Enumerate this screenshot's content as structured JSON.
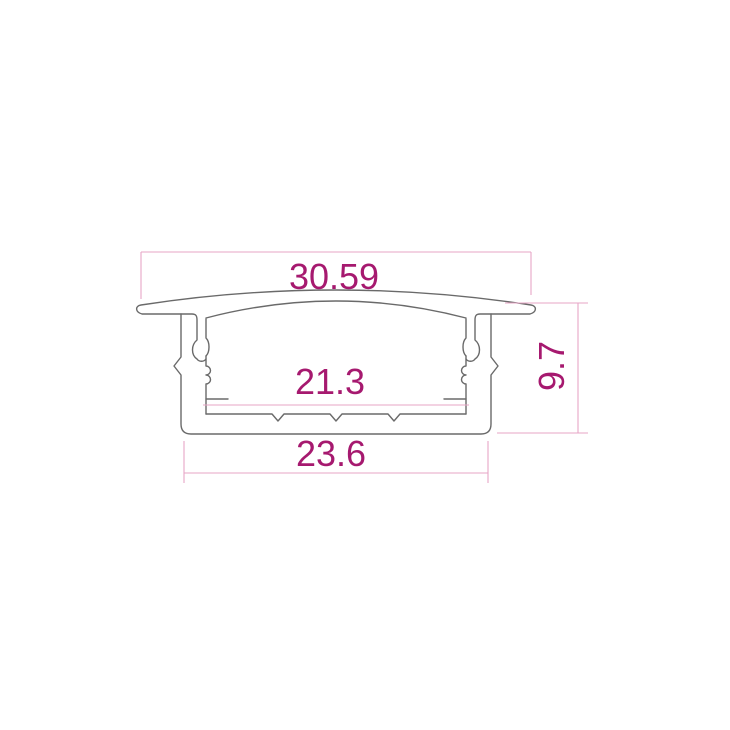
{
  "diagram": {
    "type": "technical-cross-section-drawing",
    "subject": "recessed-aluminum-channel-profile"
  },
  "dims": {
    "top_width": {
      "label": "30.59"
    },
    "inner_width": {
      "label": "21.3"
    },
    "bottom_width": {
      "label": "23.6"
    },
    "height": {
      "label": "9.7"
    }
  },
  "colors": {
    "outline": "#6a6a6a",
    "dim_line": "#e7a6c6",
    "dim_text": "#a6196f",
    "background": "#ffffff"
  }
}
